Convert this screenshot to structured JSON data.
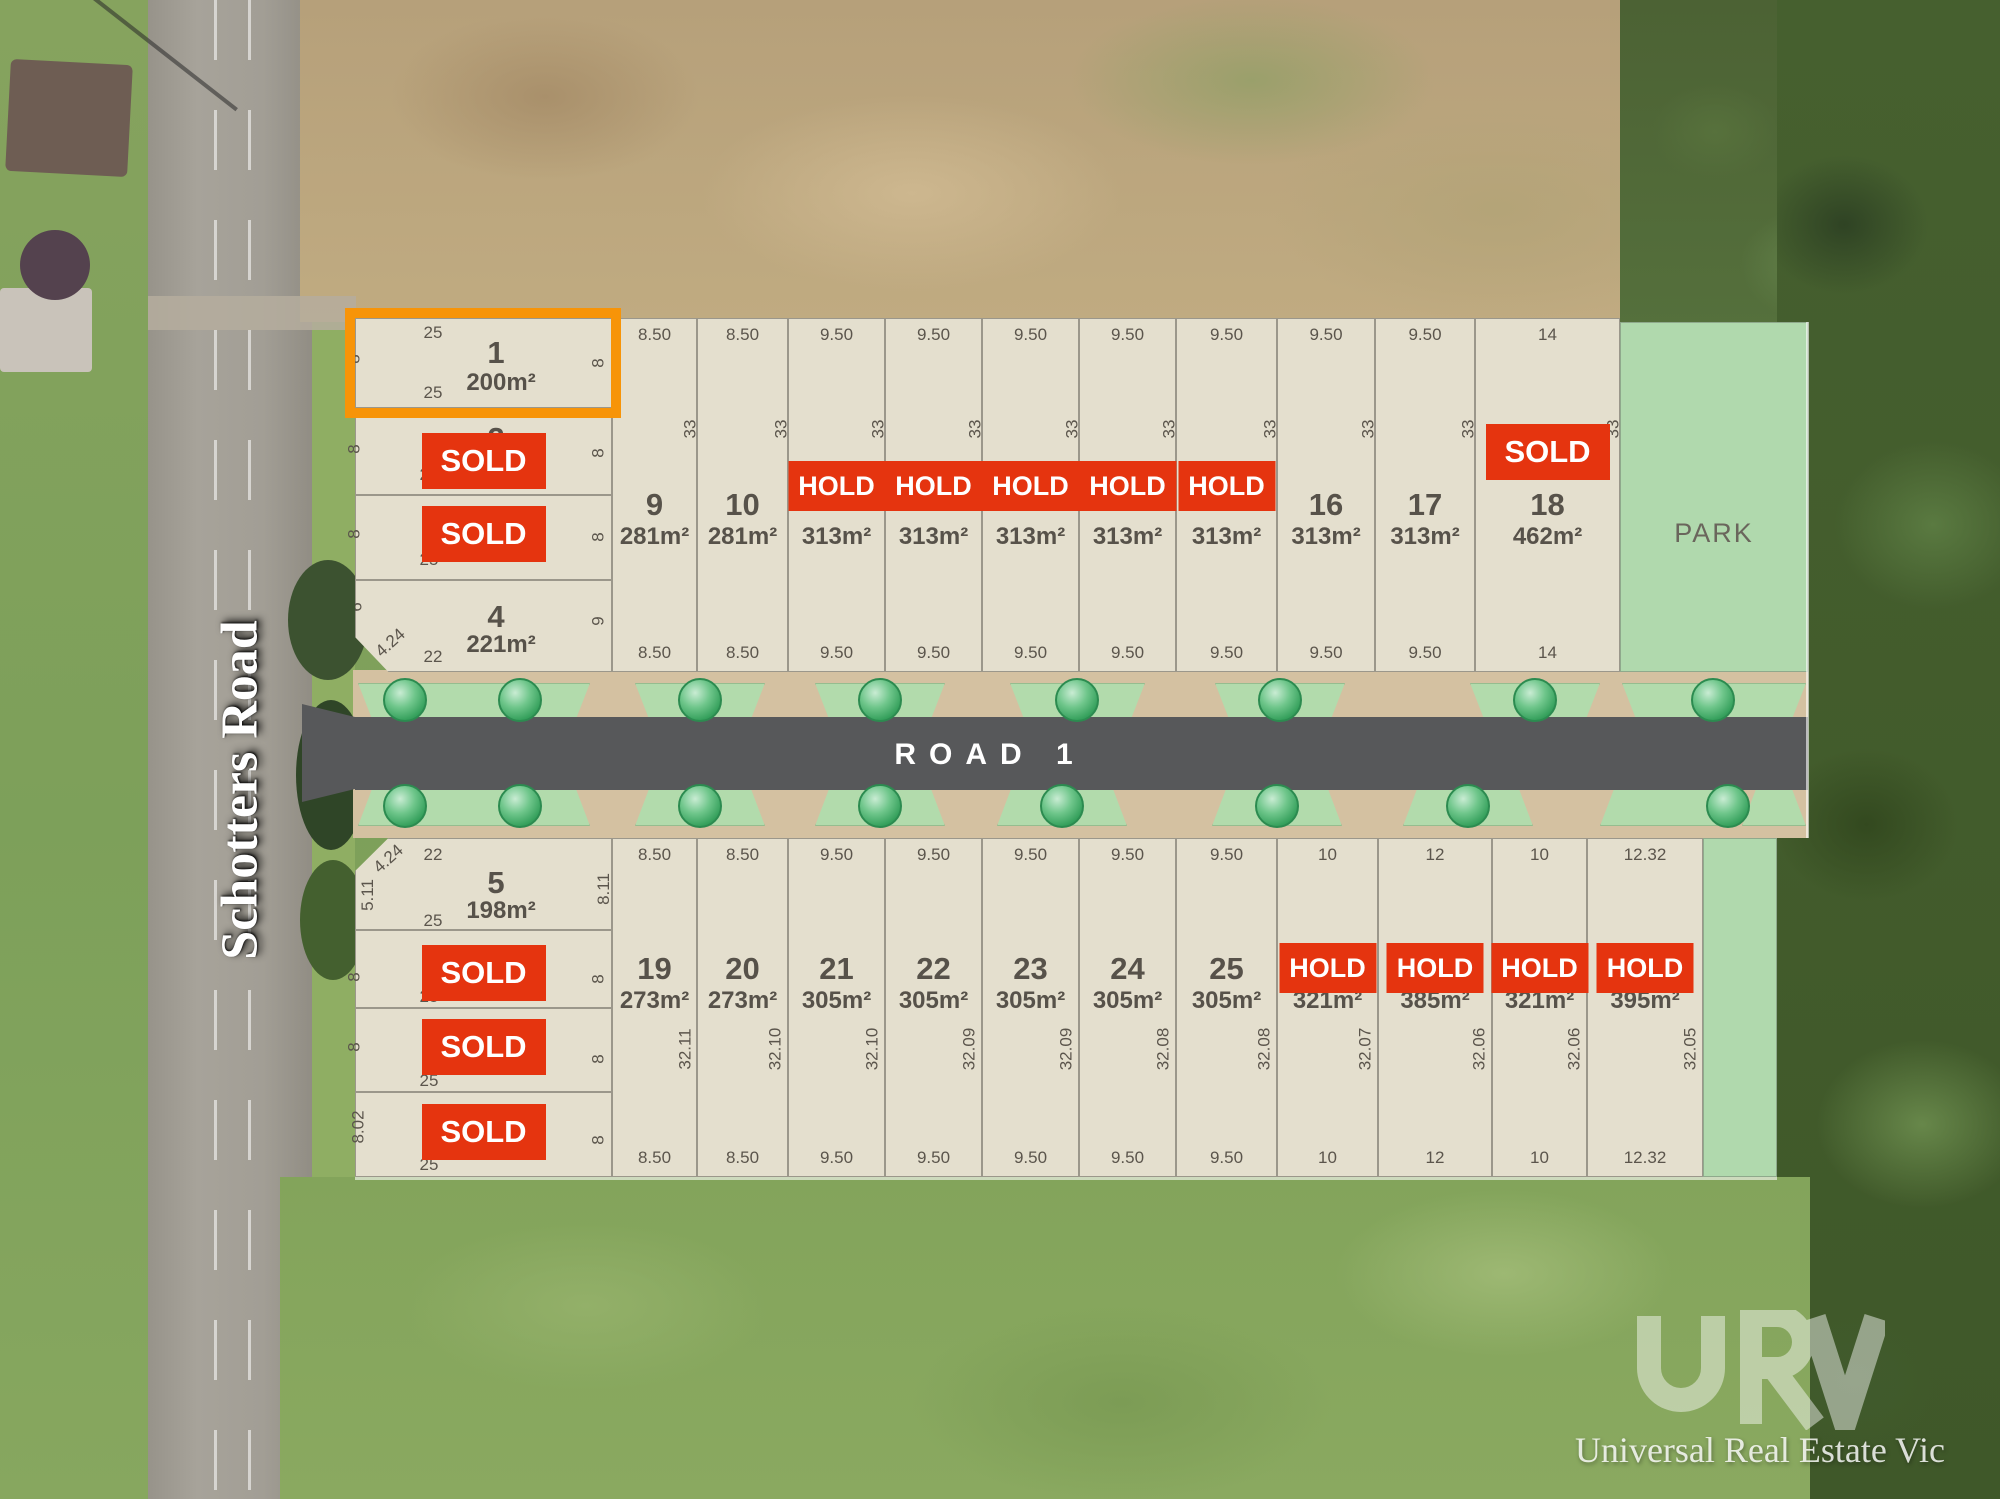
{
  "left_road": {
    "name": "Schotters Road"
  },
  "road": {
    "label": "ROAD 1"
  },
  "park": {
    "label": "PARK"
  },
  "status_labels": {
    "sold": "SOLD",
    "hold": "HOLD"
  },
  "watermark": {
    "logo": "URV",
    "text": "Universal Real Estate Vic"
  },
  "colors": {
    "status_red": "#e5340f",
    "highlight_orange": "#f79408",
    "lot_fill": "#e4dfce",
    "park_green": "#b0d9ad",
    "road_asphalt": "#57585a",
    "verge_tan": "#d4c1a1"
  },
  "plan": {
    "west_north": [
      {
        "number": "1",
        "area": "200m²",
        "status": "highlight",
        "dims": {
          "top": "25",
          "bottom": "25",
          "left": "8",
          "right": "8"
        }
      },
      {
        "number": "2",
        "area": "",
        "status": "sold",
        "dims": {
          "top": "",
          "bottom": "25",
          "left": "8",
          "right": "8"
        }
      },
      {
        "number": "",
        "area": "",
        "status": "sold",
        "dims": {
          "top": "",
          "bottom": "25",
          "left": "8",
          "right": "8"
        }
      },
      {
        "number": "4",
        "area": "221m²",
        "status": "available",
        "dims": {
          "top": "",
          "bottom": "22",
          "left": "6",
          "right": "9",
          "diag": "4.24"
        }
      }
    ],
    "west_south": [
      {
        "number": "5",
        "area": "198m²",
        "status": "available",
        "dims": {
          "top": "22",
          "bottom": "25",
          "left": "5.11",
          "right": "8.11",
          "diag": "4.24"
        }
      },
      {
        "number": "",
        "area": "",
        "status": "sold",
        "dims": {
          "top": "",
          "bottom": "25",
          "left": "8",
          "right": "8"
        }
      },
      {
        "number": "",
        "area": "",
        "status": "sold",
        "dims": {
          "top": "",
          "bottom": "25",
          "left": "8",
          "right": "8"
        }
      },
      {
        "number": "",
        "area": "",
        "status": "sold",
        "dims": {
          "top": "",
          "bottom": "25",
          "left": "8.02",
          "right": "8"
        }
      }
    ],
    "north_lots": [
      {
        "number": "9",
        "area": "281m²",
        "status": "available",
        "top": "8.50",
        "bottom": "8.50",
        "side": "33"
      },
      {
        "number": "10",
        "area": "281m²",
        "status": "available",
        "top": "8.50",
        "bottom": "8.50",
        "side": "33"
      },
      {
        "number": "",
        "area": "313m²",
        "status": "hold",
        "top": "9.50",
        "bottom": "9.50",
        "side": "33"
      },
      {
        "number": "",
        "area": "313m²",
        "status": "hold",
        "top": "9.50",
        "bottom": "9.50",
        "side": "33"
      },
      {
        "number": "",
        "area": "313m²",
        "status": "hold",
        "top": "9.50",
        "bottom": "9.50",
        "side": "33"
      },
      {
        "number": "",
        "area": "313m²",
        "status": "hold",
        "top": "9.50",
        "bottom": "9.50",
        "side": "33"
      },
      {
        "number": "",
        "area": "313m²",
        "status": "hold",
        "top": "9.50",
        "bottom": "9.50",
        "side": "33"
      },
      {
        "number": "16",
        "area": "313m²",
        "status": "available",
        "top": "9.50",
        "bottom": "9.50",
        "side": "33"
      },
      {
        "number": "17",
        "area": "313m²",
        "status": "available",
        "top": "9.50",
        "bottom": "9.50",
        "side": "33"
      },
      {
        "number": "18",
        "area": "462m²",
        "status": "sold",
        "top": "14",
        "bottom": "14",
        "side": "33"
      }
    ],
    "south_lots": [
      {
        "number": "19",
        "area": "273m²",
        "status": "available",
        "top": "8.50",
        "bottom": "8.50",
        "side": "32.11"
      },
      {
        "number": "20",
        "area": "273m²",
        "status": "available",
        "top": "8.50",
        "bottom": "8.50",
        "side": "32.10"
      },
      {
        "number": "21",
        "area": "305m²",
        "status": "available",
        "top": "9.50",
        "bottom": "9.50",
        "side": "32.10"
      },
      {
        "number": "22",
        "area": "305m²",
        "status": "available",
        "top": "9.50",
        "bottom": "9.50",
        "side": "32.09"
      },
      {
        "number": "23",
        "area": "305m²",
        "status": "available",
        "top": "9.50",
        "bottom": "9.50",
        "side": "32.09"
      },
      {
        "number": "24",
        "area": "305m²",
        "status": "available",
        "top": "9.50",
        "bottom": "9.50",
        "side": "32.08"
      },
      {
        "number": "25",
        "area": "305m²",
        "status": "available",
        "top": "9.50",
        "bottom": "9.50",
        "side": "32.08"
      },
      {
        "number": "",
        "area": "321m²",
        "status": "hold",
        "top": "10",
        "bottom": "10",
        "side": "32.07"
      },
      {
        "number": "",
        "area": "385m²",
        "status": "hold",
        "top": "12",
        "bottom": "12",
        "side": "32.06"
      },
      {
        "number": "",
        "area": "321m²",
        "status": "hold",
        "top": "10",
        "bottom": "10",
        "side": "32.06"
      },
      {
        "number": "",
        "area": "395m²",
        "status": "hold",
        "top": "12.32",
        "bottom": "12.32",
        "side": "32.05"
      }
    ]
  }
}
